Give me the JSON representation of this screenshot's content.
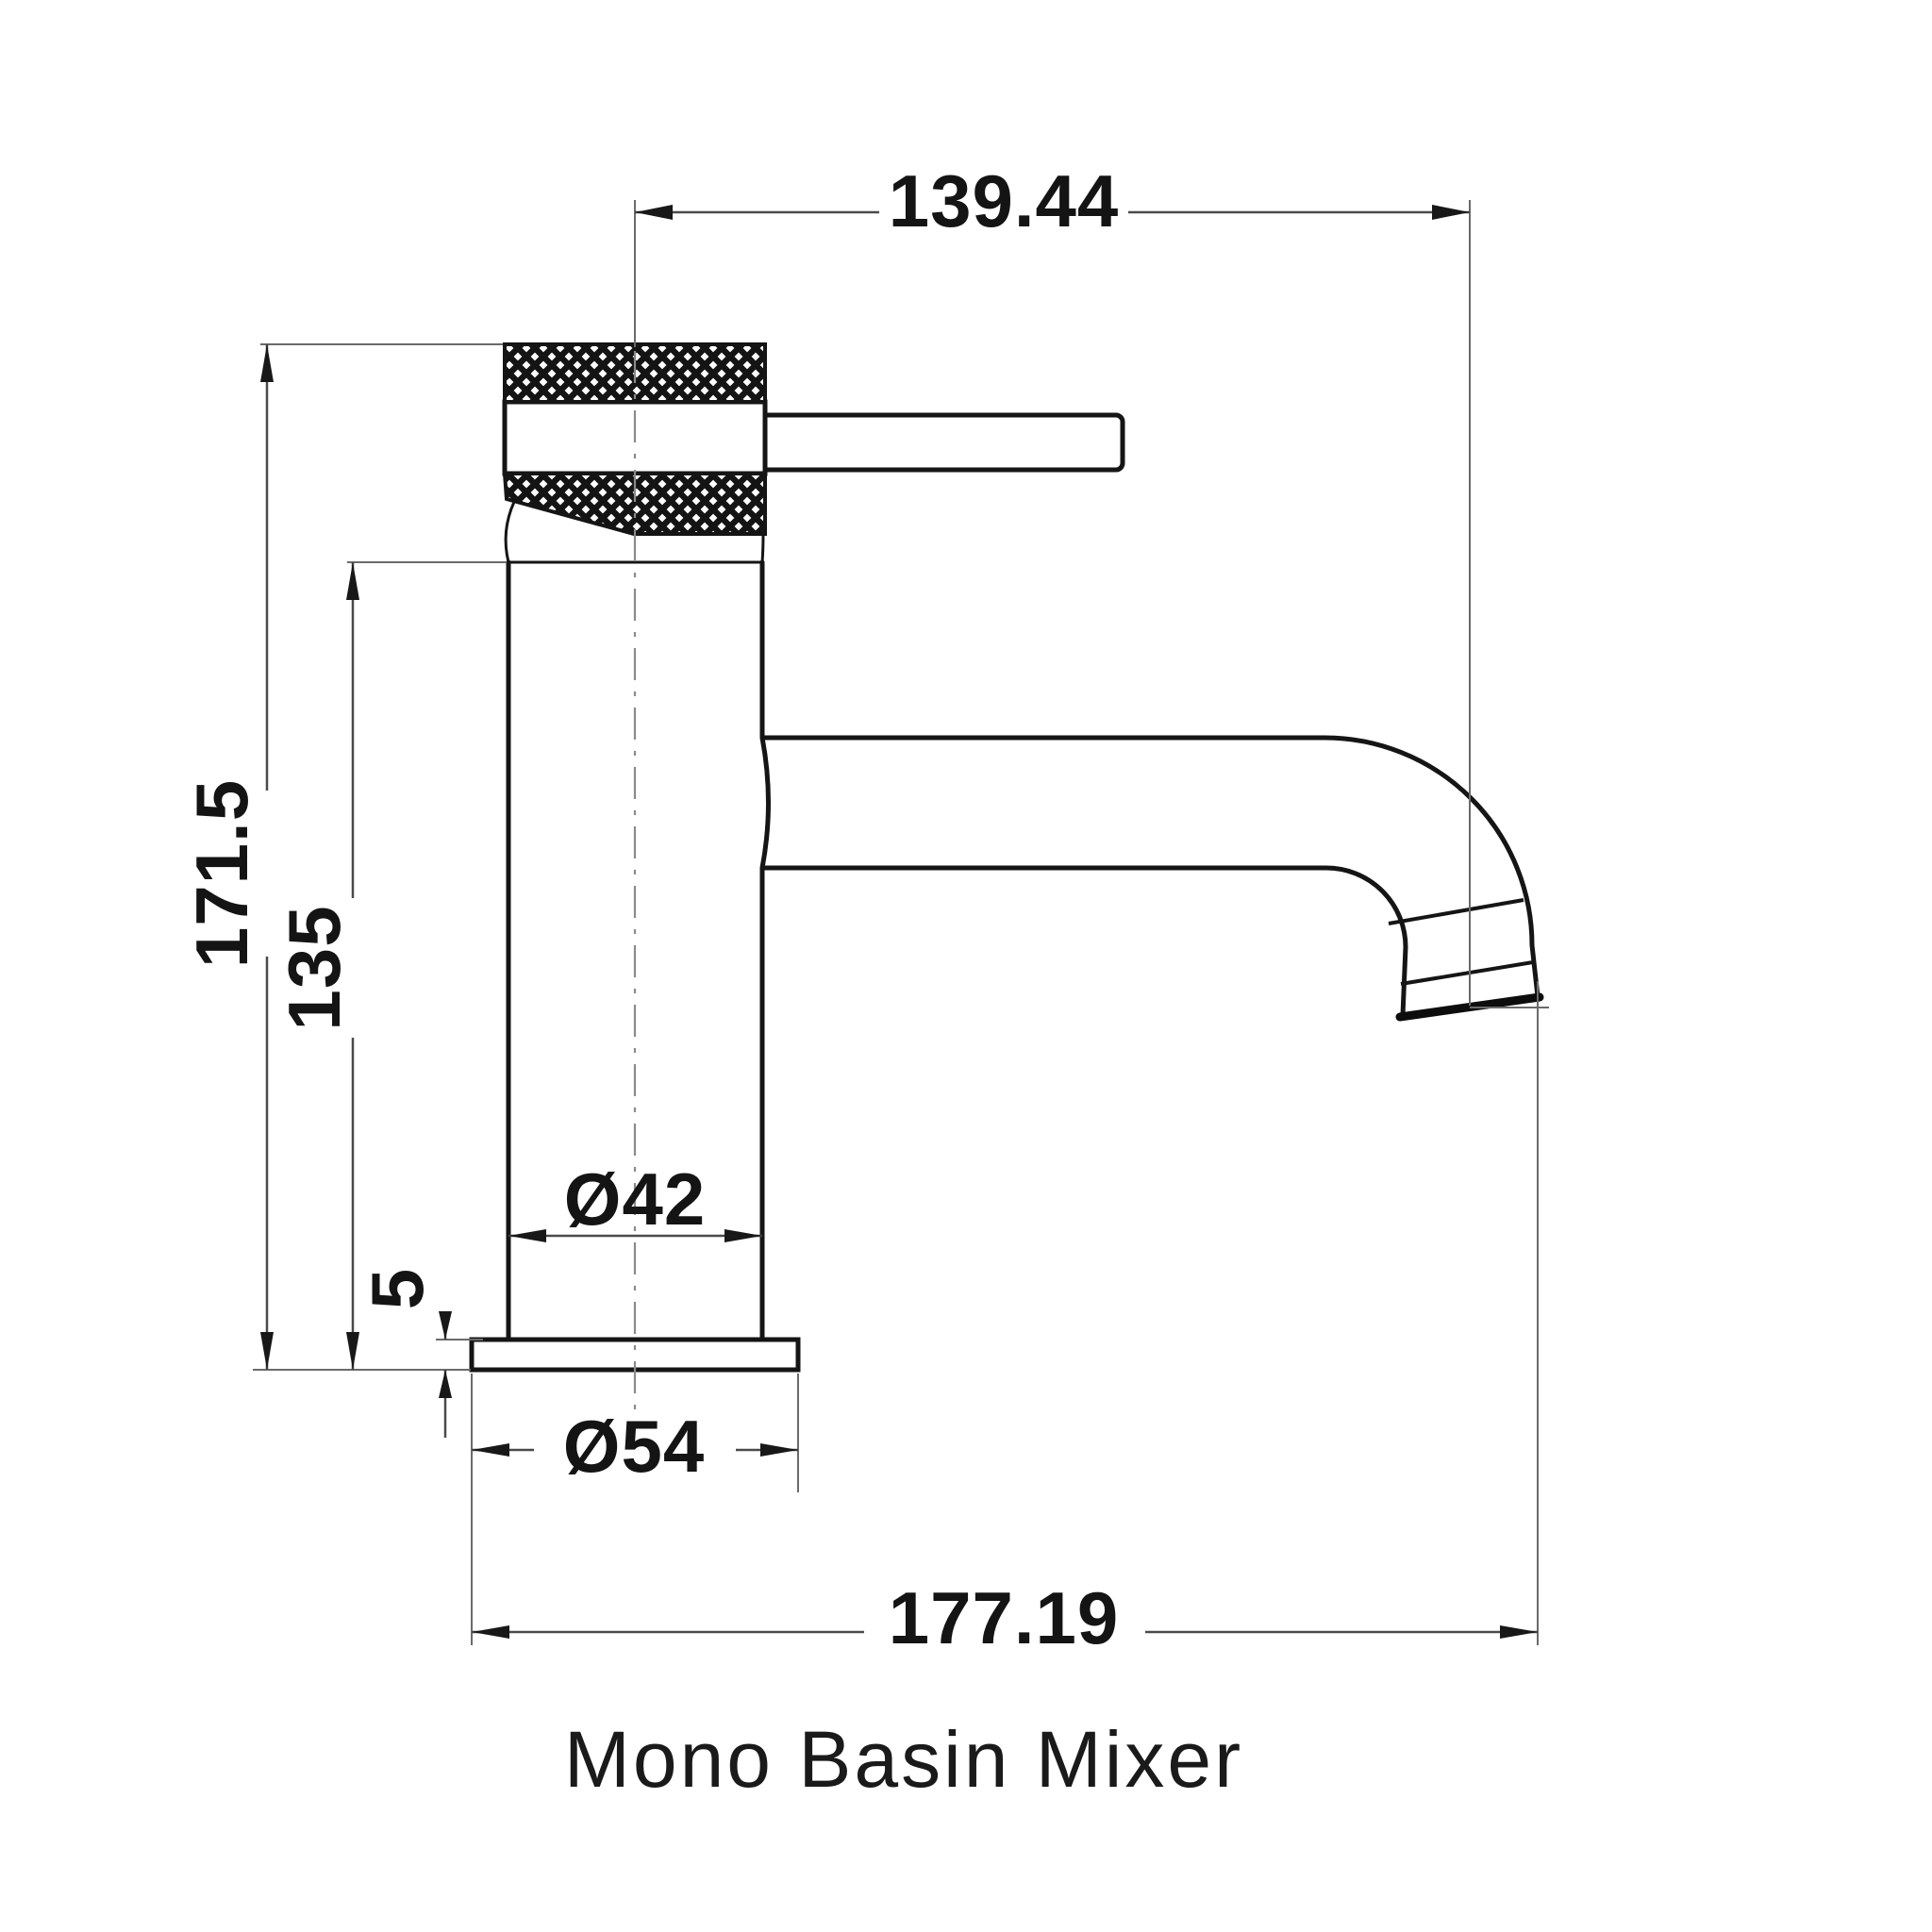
{
  "drawing": {
    "caption": "Mono Basin Mixer",
    "units_note": "mm",
    "dimensions": {
      "spout_reach": "139.44",
      "overall_height": "171.5",
      "body_height": "135",
      "body_diameter": "Ø42",
      "base_thickness": "5",
      "base_diameter": "Ø54",
      "overall_depth": "177.19"
    }
  }
}
